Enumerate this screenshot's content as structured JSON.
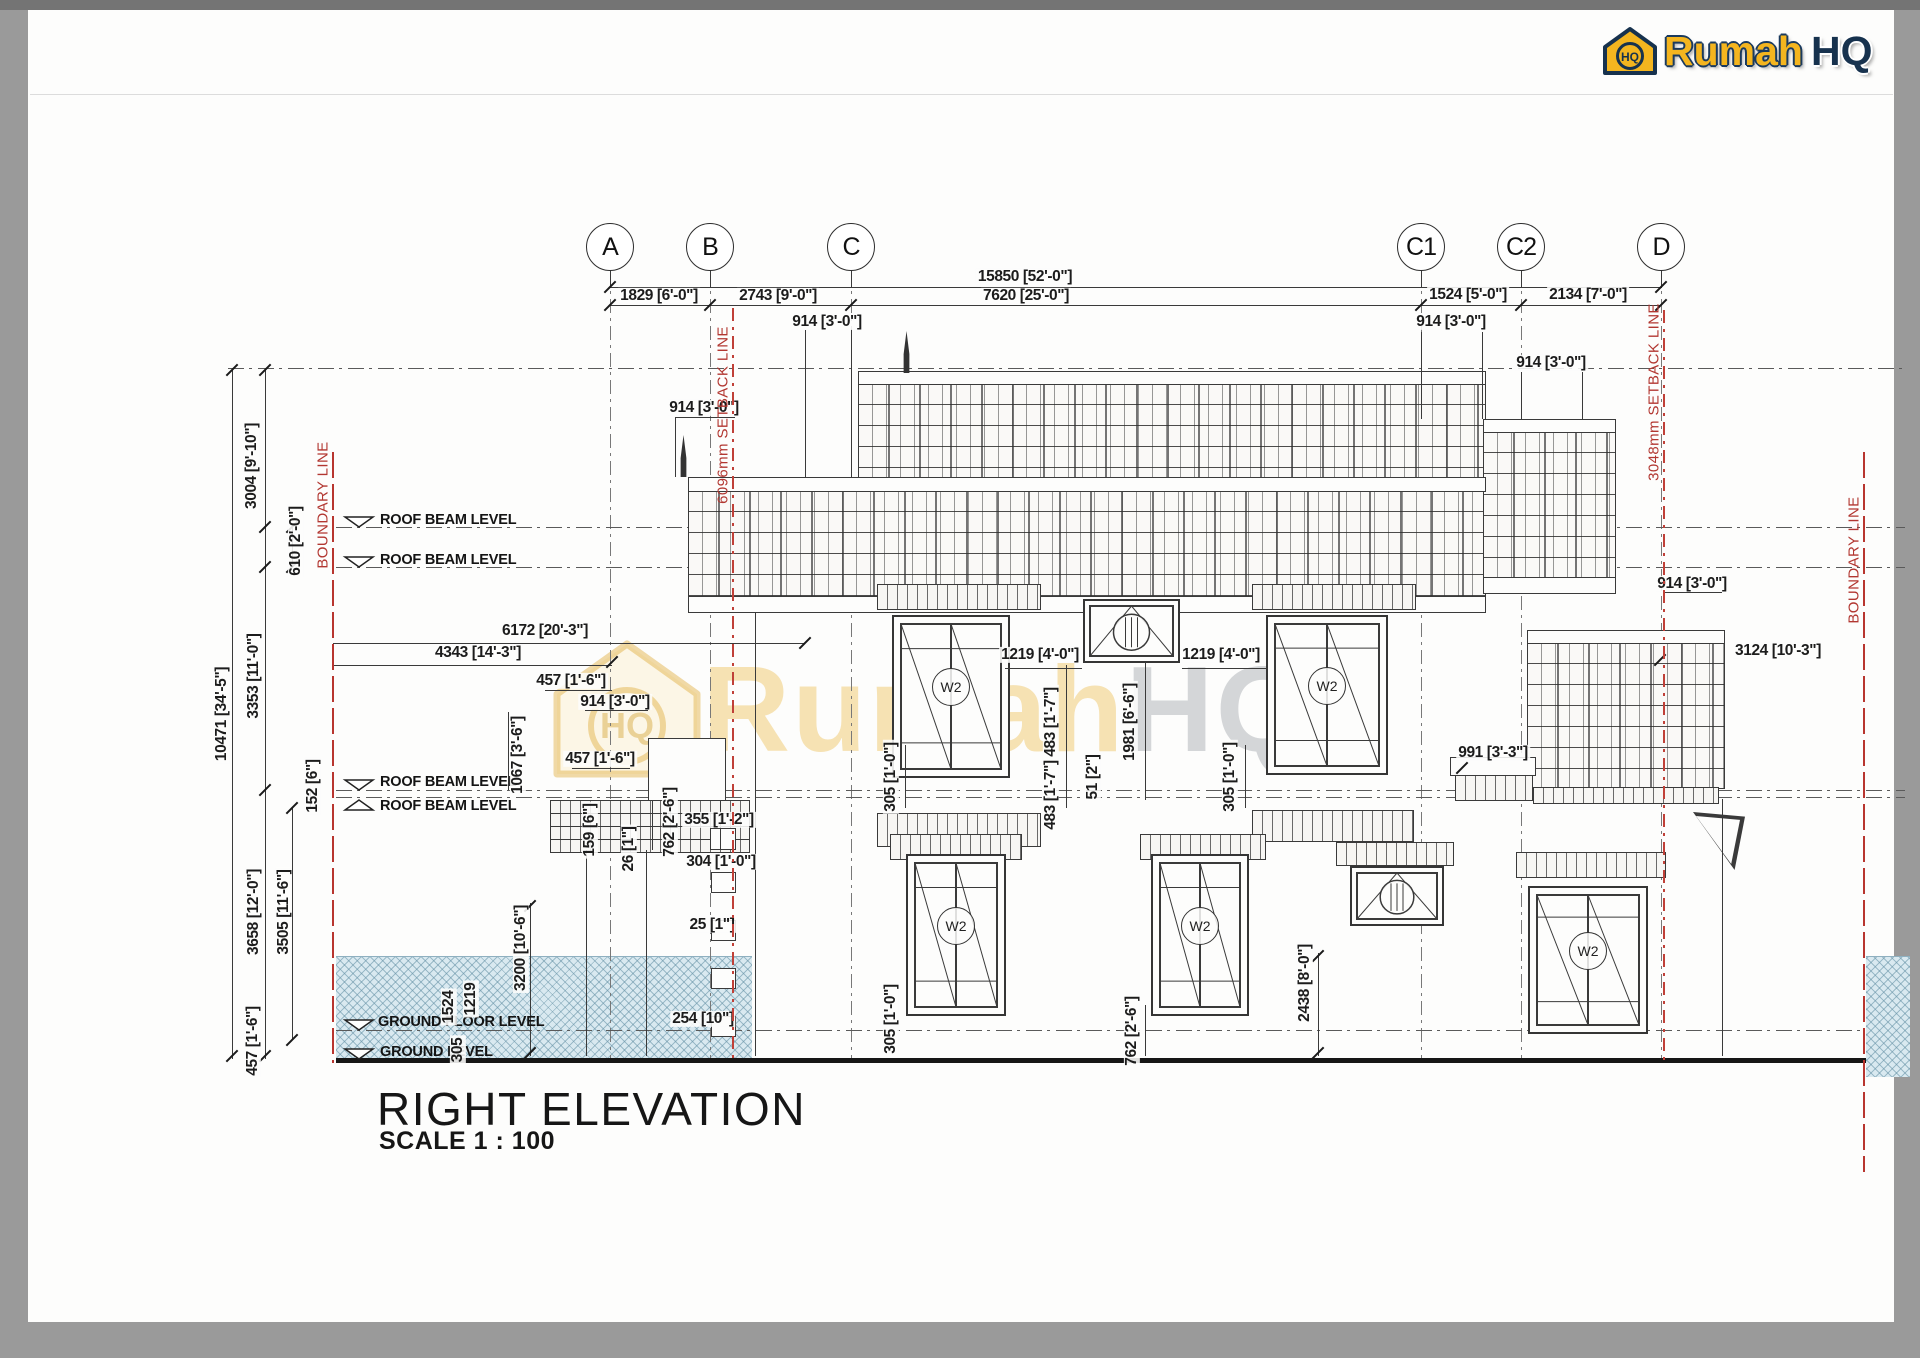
{
  "page": {
    "background": "#9a9a9a",
    "paper": "#fdfdfc",
    "accent_red": "#b23731",
    "hatch_blue": "#d9e9f0",
    "brand_yellow": "#f4b51f",
    "brand_navy": "#17324e"
  },
  "logo": {
    "word1": "Rumah",
    "word2": "HQ",
    "icon_monogram": "HQ"
  },
  "watermark": {
    "word1": "Rumah",
    "word2": "HQ",
    "icon_monogram": "HQ"
  },
  "title_block": {
    "title": "RIGHT ELEVATION",
    "scale": "SCALE 1 : 100"
  },
  "window_tag": "W2",
  "grid_bubbles": [
    {
      "label": "A",
      "x": 610
    },
    {
      "label": "B",
      "x": 710
    },
    {
      "label": "C",
      "x": 851
    },
    {
      "label": "C1",
      "x": 1421
    },
    {
      "label": "C2",
      "x": 1521
    },
    {
      "label": "D",
      "x": 1661
    }
  ],
  "levels": [
    {
      "label": "ROOF BEAM LEVEL",
      "tx": 380,
      "ty": 520,
      "marker": "down",
      "line_y": 527,
      "x2": 1905
    },
    {
      "label": "ROOF BEAM LEVEL",
      "tx": 380,
      "ty": 560,
      "marker": "down",
      "line_y": 567,
      "x2": 1905
    },
    {
      "label": "ROOF BEAM LEVEL",
      "tx": 380,
      "ty": 782,
      "marker": "down",
      "line_y": 790,
      "x2": 1905
    },
    {
      "label": "ROOF BEAM LEVEL",
      "tx": 380,
      "ty": 806,
      "marker": "up",
      "line_y": 797,
      "x2": 1905
    },
    {
      "label": "GROUND FLOOR LEVEL",
      "tx": 378,
      "ty": 1022,
      "marker": "down",
      "line_y": 1030,
      "x2": 1864
    },
    {
      "label": "GROUND LEVEL",
      "tx": 380,
      "ty": 1052,
      "marker": "down",
      "line_y": 1059,
      "no_line": true,
      "x2": 1864
    }
  ],
  "site_lines": [
    {
      "label": "BOUNDARY LINE",
      "x": 333,
      "y1": 452,
      "y2": 1063,
      "ly": 505,
      "style": "solid"
    },
    {
      "label": "6096mm SETBACK LINE",
      "x": 733,
      "y1": 308,
      "y2": 1063,
      "ly": 415,
      "style": "dash"
    },
    {
      "label": "3048mm SETBACK LINE",
      "x": 1664,
      "y1": 310,
      "y2": 1063,
      "ly": 392,
      "style": "dash"
    },
    {
      "label": "BOUNDARY LINE",
      "x": 1864,
      "y1": 452,
      "y2": 1172,
      "ly": 560,
      "style": "solid"
    }
  ],
  "dimensions": [
    {
      "t": "15850 [52'-0\"]",
      "x": 1025,
      "y": 277
    },
    {
      "t": "1829 [6'-0\"]",
      "x": 659,
      "y": 296
    },
    {
      "t": "2743 [9'-0\"]",
      "x": 778,
      "y": 296
    },
    {
      "t": "7620 [25'-0\"]",
      "x": 1026,
      "y": 296
    },
    {
      "t": "1524 [5'-0\"]",
      "x": 1468,
      "y": 295
    },
    {
      "t": "2134 [7'-0\"]",
      "x": 1588,
      "y": 295
    },
    {
      "t": "914 [3'-0\"]",
      "x": 827,
      "y": 322
    },
    {
      "t": "914 [3'-0\"]",
      "x": 1451,
      "y": 322
    },
    {
      "t": "914 [3'-0\"]",
      "x": 1551,
      "y": 363
    },
    {
      "t": "914 [3'-0\"]",
      "x": 704,
      "y": 408
    },
    {
      "t": "914 [3'-0\"]",
      "x": 1692,
      "y": 584
    },
    {
      "t": "3004 [9'-10\"]",
      "x": 252,
      "y": 466,
      "v": 1
    },
    {
      "t": "610 [2'-0\"]",
      "x": 296,
      "y": 541,
      "v": 1
    },
    {
      "t": "10471 [34'-5\"]",
      "x": 222,
      "y": 714,
      "v": 1
    },
    {
      "t": "3353 [11'-0\"]",
      "x": 254,
      "y": 676,
      "v": 1
    },
    {
      "t": "152 [6\"]",
      "x": 313,
      "y": 786,
      "v": 1
    },
    {
      "t": "3658 [12'-0\"]",
      "x": 254,
      "y": 912,
      "v": 1
    },
    {
      "t": "3505 [11'-6\"]",
      "x": 284,
      "y": 912,
      "v": 1
    },
    {
      "t": "457 [1'-6\"]",
      "x": 253,
      "y": 1041,
      "v": 1
    },
    {
      "t": "6172 [20'-3\"]",
      "x": 545,
      "y": 631
    },
    {
      "t": "4343 [14'-3\"]",
      "x": 478,
      "y": 653
    },
    {
      "t": "457 [1'-6\"]",
      "x": 571,
      "y": 681
    },
    {
      "t": "914 [3'-0\"]",
      "x": 615,
      "y": 702
    },
    {
      "t": "457 [1'-6\"]",
      "x": 600,
      "y": 759
    },
    {
      "t": "1067 [3'-6\"]",
      "x": 518,
      "y": 755,
      "v": 1
    },
    {
      "t": "159 [6\"]",
      "x": 590,
      "y": 830,
      "v": 1
    },
    {
      "t": "26 [1\"]",
      "x": 629,
      "y": 849,
      "v": 1
    },
    {
      "t": "762 [2'-6\"]",
      "x": 670,
      "y": 822,
      "v": 1
    },
    {
      "t": "355 [1'-2\"]",
      "x": 719,
      "y": 820
    },
    {
      "t": "304 [1'-0\"]",
      "x": 721,
      "y": 862
    },
    {
      "t": "25 [1\"]",
      "x": 712,
      "y": 925
    },
    {
      "t": "254 [10\"]",
      "x": 703,
      "y": 1019
    },
    {
      "t": "1524",
      "x": 449,
      "y": 1007,
      "v": 1
    },
    {
      "t": "1219",
      "x": 471,
      "y": 999,
      "v": 1
    },
    {
      "t": "305",
      "x": 458,
      "y": 1050,
      "v": 1
    },
    {
      "t": "3200 [10'-6\"]",
      "x": 521,
      "y": 948,
      "v": 1
    },
    {
      "t": "1219 [4'-0\"]",
      "x": 1040,
      "y": 655
    },
    {
      "t": "1219 [4'-0\"]",
      "x": 1221,
      "y": 655
    },
    {
      "t": "483 [1'-7\"]",
      "x": 1051,
      "y": 722,
      "v": 1
    },
    {
      "t": "483 [1'-7\"]",
      "x": 1051,
      "y": 795,
      "v": 1
    },
    {
      "t": "51 [2\"]",
      "x": 1093,
      "y": 777,
      "v": 1
    },
    {
      "t": "1981 [6'-6\"]",
      "x": 1130,
      "y": 722,
      "v": 1
    },
    {
      "t": "305 [1'-0\"]",
      "x": 891,
      "y": 777,
      "v": 1
    },
    {
      "t": "305 [1'-0\"]",
      "x": 1230,
      "y": 777,
      "v": 1
    },
    {
      "t": "305 [1'-0\"]",
      "x": 891,
      "y": 1019,
      "v": 1
    },
    {
      "t": "762 [2'-6\"]",
      "x": 1132,
      "y": 1031,
      "v": 1
    },
    {
      "t": "2438 [8'-0\"]",
      "x": 1305,
      "y": 983,
      "v": 1
    },
    {
      "t": "3124 [10'-3\"]",
      "x": 1778,
      "y": 651
    },
    {
      "t": "991 [3'-3\"]",
      "x": 1493,
      "y": 753
    }
  ],
  "layout": {
    "hatches": [
      {
        "x": 336,
        "y": 956,
        "w": 416,
        "h": 102
      },
      {
        "x": 1866,
        "y": 956,
        "w": 44,
        "h": 120
      }
    ],
    "dashdot_h": [
      [
        228,
        368,
        1905
      ]
    ],
    "dashdot_v": [
      [
        610,
        272,
        1059
      ],
      [
        710,
        272,
        1059
      ],
      [
        851,
        272,
        1059
      ],
      [
        1421,
        272,
        1059
      ],
      [
        1521,
        272,
        1059
      ],
      [
        1661,
        272,
        1059
      ]
    ],
    "hlines": [
      [
        610,
        287,
        1661
      ],
      [
        610,
        305,
        1661
      ],
      [
        333,
        643,
        805
      ],
      [
        333,
        665,
        612
      ],
      [
        545,
        690,
        612
      ],
      [
        585,
        710,
        648
      ],
      [
        572,
        768,
        630
      ],
      [
        675,
        417,
        735
      ],
      [
        1664,
        592,
        1722
      ],
      [
        1005,
        668,
        1082
      ],
      [
        1182,
        668,
        1268
      ]
    ],
    "vlines": [
      [
        232,
        370,
        1059
      ],
      [
        265,
        370,
        1059
      ],
      [
        292,
        527,
        567
      ],
      [
        292,
        808,
        1040
      ],
      [
        310,
        790,
        808
      ],
      [
        805,
        330,
        477
      ],
      [
        851,
        330,
        477
      ],
      [
        1421,
        332,
        419
      ],
      [
        1482,
        332,
        419
      ],
      [
        1521,
        372,
        419
      ],
      [
        1582,
        372,
        419
      ],
      [
        675,
        417,
        477
      ],
      [
        508,
        712,
        790
      ],
      [
        530,
        903,
        1056
      ],
      [
        586,
        850,
        1056
      ],
      [
        646,
        850,
        1056
      ],
      [
        1066,
        665,
        808
      ],
      [
        1145,
        662,
        800
      ],
      [
        1245,
        745,
        808
      ],
      [
        905,
        745,
        808
      ],
      [
        1145,
        1005,
        1056
      ],
      [
        1318,
        953,
        1056
      ],
      [
        755,
        612,
        1056
      ],
      [
        1722,
        799,
        1056
      ],
      [
        652,
        800,
        850
      ],
      [
        720,
        800,
        850
      ]
    ],
    "ticks": [
      [
        610,
        287
      ],
      [
        1661,
        287
      ],
      [
        610,
        305
      ],
      [
        710,
        305
      ],
      [
        851,
        305
      ],
      [
        1421,
        305
      ],
      [
        1521,
        305
      ],
      [
        1661,
        305
      ],
      [
        805,
        643
      ],
      [
        612,
        662
      ],
      [
        232,
        370
      ],
      [
        232,
        1056
      ],
      [
        265,
        370
      ],
      [
        265,
        527
      ],
      [
        265,
        567
      ],
      [
        265,
        790
      ],
      [
        265,
        1056
      ],
      [
        292,
        527
      ],
      [
        292,
        567
      ],
      [
        292,
        808
      ],
      [
        292,
        1040
      ],
      [
        530,
        906
      ],
      [
        530,
        1053
      ],
      [
        1318,
        956
      ],
      [
        1318,
        1053
      ],
      [
        1660,
        660
      ],
      [
        1462,
        768
      ]
    ],
    "shingles": [
      {
        "x": 858,
        "y": 383,
        "w": 626,
        "h": 95
      },
      {
        "x": 688,
        "y": 490,
        "w": 796,
        "h": 106
      },
      {
        "x": 1483,
        "y": 431,
        "w": 131,
        "h": 146
      },
      {
        "x": 1527,
        "y": 642,
        "w": 196,
        "h": 145
      }
    ],
    "caps": [
      {
        "x": 858,
        "y": 371,
        "w": 626,
        "h": 12
      },
      {
        "x": 688,
        "y": 477,
        "w": 796,
        "h": 13
      },
      {
        "x": 1483,
        "y": 419,
        "w": 131,
        "h": 12
      },
      {
        "x": 1527,
        "y": 630,
        "w": 196,
        "h": 12
      },
      {
        "x": 688,
        "y": 596,
        "w": 796,
        "h": 15
      },
      {
        "x": 1483,
        "y": 577,
        "w": 131,
        "h": 15
      },
      {
        "x": 648,
        "y": 738,
        "w": 76,
        "h": 62
      },
      {
        "x": 1450,
        "y": 757,
        "w": 84,
        "h": 17
      }
    ],
    "bricks": [
      {
        "x": 877,
        "y": 584,
        "w": 162,
        "h": 24
      },
      {
        "x": 1252,
        "y": 584,
        "w": 162,
        "h": 24
      },
      {
        "x": 877,
        "y": 813,
        "w": 162,
        "h": 32
      },
      {
        "x": 1252,
        "y": 810,
        "w": 160,
        "h": 30
      },
      {
        "x": 890,
        "y": 834,
        "w": 130,
        "h": 24
      },
      {
        "x": 1140,
        "y": 834,
        "w": 124,
        "h": 24
      },
      {
        "x": 1336,
        "y": 842,
        "w": 116,
        "h": 22
      },
      {
        "x": 1516,
        "y": 852,
        "w": 148,
        "h": 24
      },
      {
        "x": 550,
        "y": 800,
        "w": 198,
        "h": 12
      },
      {
        "x": 550,
        "y": 813,
        "w": 198,
        "h": 12
      },
      {
        "x": 550,
        "y": 826,
        "w": 198,
        "h": 12
      },
      {
        "x": 550,
        "y": 839,
        "w": 198,
        "h": 12
      },
      {
        "x": 1455,
        "y": 775,
        "w": 76,
        "h": 24
      },
      {
        "x": 1533,
        "y": 787,
        "w": 184,
        "h": 15
      }
    ],
    "steps": [
      {
        "x": 710,
        "y": 828,
        "w": 24,
        "h": 20
      },
      {
        "x": 711,
        "y": 872,
        "w": 23,
        "h": 19
      },
      {
        "x": 711,
        "y": 920,
        "w": 23,
        "h": 19
      },
      {
        "x": 711,
        "y": 968,
        "w": 23,
        "h": 19
      },
      {
        "x": 711,
        "y": 1016,
        "w": 23,
        "h": 19
      }
    ],
    "spires": [
      {
        "x": 679,
        "y": 435
      },
      {
        "x": 902,
        "y": 331
      }
    ],
    "windows": [
      {
        "x": 892,
        "y": 615,
        "w": 118,
        "h": 163,
        "tag": "W2",
        "type": "c"
      },
      {
        "x": 1083,
        "y": 599,
        "w": 97,
        "h": 64,
        "type": "f"
      },
      {
        "x": 1266,
        "y": 615,
        "w": 122,
        "h": 160,
        "tag": "W2",
        "type": "c"
      },
      {
        "x": 906,
        "y": 854,
        "w": 100,
        "h": 162,
        "tag": "W2",
        "type": "c"
      },
      {
        "x": 1151,
        "y": 854,
        "w": 98,
        "h": 162,
        "tag": "W2",
        "type": "c"
      },
      {
        "x": 1350,
        "y": 866,
        "w": 94,
        "h": 60,
        "type": "f"
      },
      {
        "x": 1528,
        "y": 886,
        "w": 120,
        "h": 148,
        "tag": "W2",
        "type": "c"
      }
    ],
    "ground_line": {
      "x": 336,
      "y": 1058,
      "w": 1530,
      "h": 5
    },
    "bracket": {
      "x": 1693,
      "y": 812,
      "w": 52,
      "h": 58
    }
  }
}
